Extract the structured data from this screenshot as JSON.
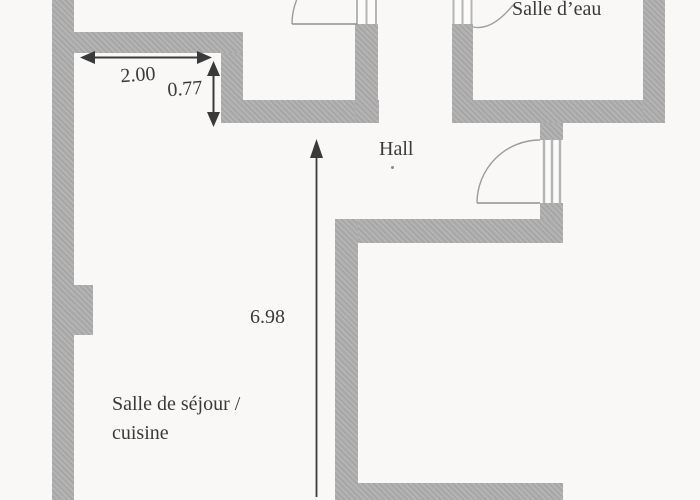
{
  "plan": {
    "kind": "apartment floor plan scan",
    "rooms": {
      "salle_deau": "Salle d’eau",
      "hall": "Hall",
      "sejour_line1": "Salle de séjour /",
      "sejour_line2": "cuisine"
    },
    "dimensions": {
      "top_width": "2.00",
      "top_offset": "0.77",
      "main_height": "6.98"
    },
    "colors": {
      "wall": "#aeaeae",
      "background": "#f9f8f6",
      "ink": "#3a3a3a",
      "frame_line": "#b5b5b5",
      "door_arc": "#9c9c9c"
    }
  }
}
